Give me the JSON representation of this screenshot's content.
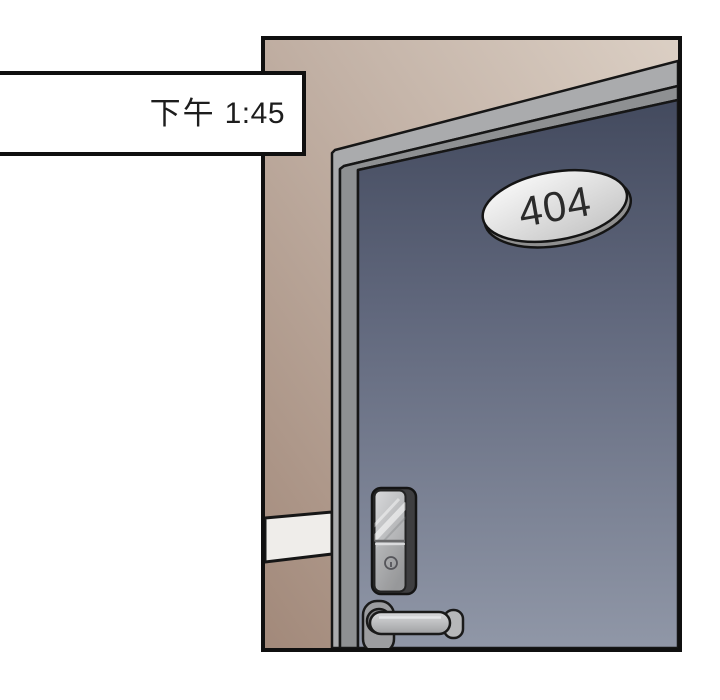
{
  "page": {
    "background_color": "#ffffff"
  },
  "timestamp_box": {
    "period": "下午",
    "time": "1:45",
    "text_color": "#1d1d1d",
    "background_color": "#ffffff",
    "border_color": "#101010"
  },
  "panel": {
    "border_color": "#101010",
    "wall": {
      "light_color": "#dbcfc4",
      "mid_color": "#c2b1a5",
      "dark_color": "#a2897a",
      "baseboard_color": "#efedea",
      "outline_color": "#161616"
    },
    "door_frame": {
      "outer_band_color": "#aaabad",
      "inner_band_color": "#8e9092",
      "outline_color": "#161616"
    },
    "door": {
      "top_color": "#434a5e",
      "mid_color": "#60677c",
      "bottom_color": "#9097a7",
      "outline_color": "#161616"
    },
    "room_plaque": {
      "number": "404",
      "text_color": "#2b2b2b",
      "face_light_color": "#fdfdfd",
      "face_dark_color": "#c8c8c8",
      "rim_color": "#8f8f8f",
      "outline_color": "#141414"
    },
    "lock": {
      "body_color": "#3e3e40",
      "face_light_color": "#d8d9db",
      "face_dark_color": "#9fa0a2",
      "divider_dark_color": "#6a6a6c",
      "divider_light_color": "#e8e8ea",
      "keyhole_color": "#55555a",
      "outline_color": "#141414"
    },
    "handle": {
      "rosette_color": "#9c9da0",
      "hub_color": "#88898c",
      "lever_light_color": "#dadbdd",
      "lever_dark_color": "#9fa0a2",
      "cap_color": "#b6b7b9",
      "outline_color": "#1a1a1a"
    }
  }
}
